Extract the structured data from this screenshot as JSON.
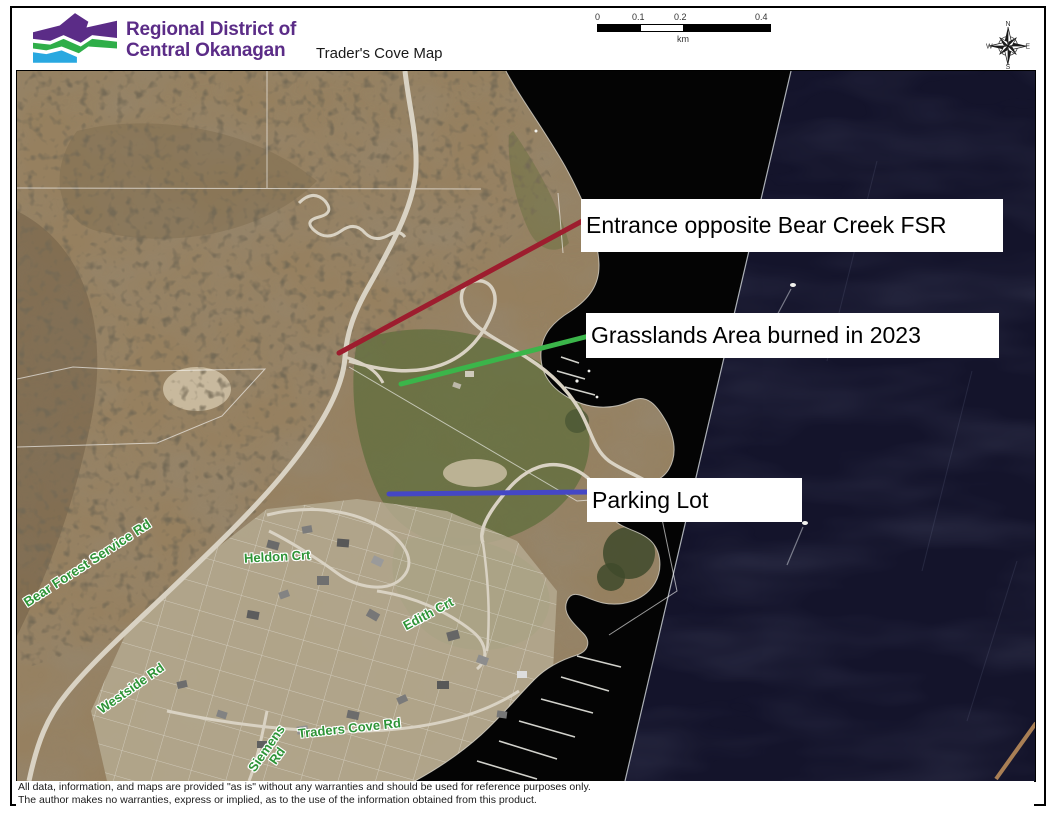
{
  "header": {
    "org_line1": "Regional District of",
    "org_line2": "Central Okanagan",
    "map_title": "Trader's Cove Map",
    "scale": {
      "t0": "0",
      "t1": "0.1",
      "t2": "0.2",
      "t3": "0.4",
      "unit": "km"
    },
    "compass": {
      "n": "N",
      "e": "E",
      "s": "S",
      "w": "W"
    }
  },
  "map": {
    "label_entrance": "Entrance opposite Bear Creek FSR",
    "label_grasslands": "Grasslands Area burned in 2023",
    "label_parking": "Parking Lot",
    "road_bear_fsr": "Bear Forest Service Rd",
    "road_westside": "Westside Rd",
    "road_heldon": "Heldon Crt",
    "road_edith": "Edith Crt",
    "road_traders": "Traders Cove Rd",
    "road_siemens_1": "Siemens",
    "road_siemens_2": "Rd",
    "colors": {
      "entrance_line": "#9d1d2e",
      "grasslands_line": "#3bb54a",
      "parking_line": "#4547c5",
      "road_label_green": "#2e9437",
      "logo_purple": "#5b2c87",
      "logo_green": "#2fae49",
      "logo_blue": "#29a8e0"
    }
  },
  "footer": {
    "line1": "All data, information, and maps are provided \"as is\" without any warranties and should be used for reference purposes only.",
    "line2": "The author makes no warranties, express or implied, as to the use of the information obtained from this product."
  }
}
